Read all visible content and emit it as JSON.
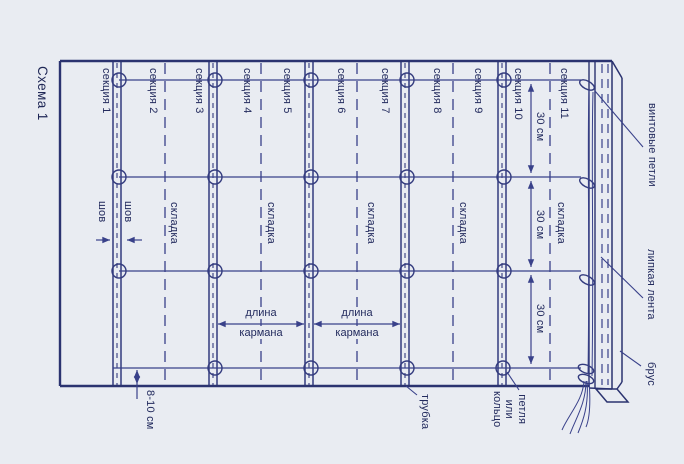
{
  "title": "Схема 1",
  "sections": [
    "секция 1",
    "секция 2",
    "секция 3",
    "секция 4",
    "секция 5",
    "секция 6",
    "секция 7",
    "секция 8",
    "секция 9",
    "секция 10",
    "секция 11"
  ],
  "labels": {
    "seam": "шов",
    "fold": "складка",
    "row_spacing": "30 см",
    "bottom_offset": "8-10 см",
    "pocket_length_line1": "длина",
    "pocket_length_line2": "кармана",
    "tube": "трубка",
    "ring_line1": "петля",
    "ring_line2": "или",
    "ring_line3": "кольцо",
    "screw_loops": "винтовые петли",
    "sticky_tape": "липкая лента",
    "beam": "брус"
  },
  "colors": {
    "background": "#e9ecf2",
    "line": "#39418a",
    "border": "#2b3370",
    "text": "#232b5e"
  }
}
